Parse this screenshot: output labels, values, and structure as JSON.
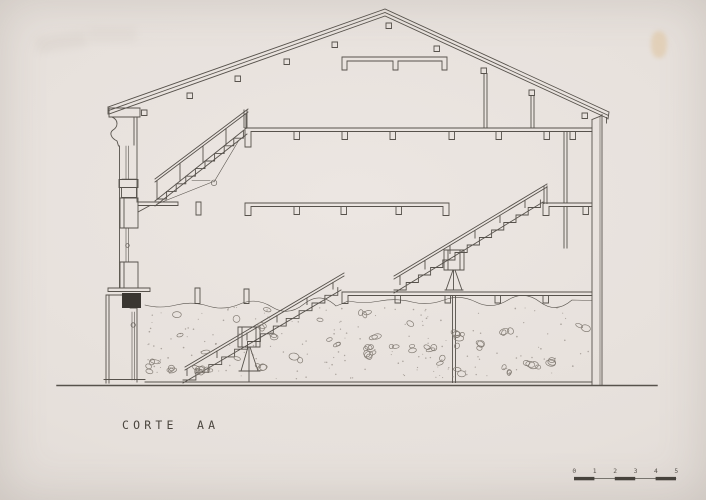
{
  "title": {
    "word1": "CORTE",
    "word2": "AA"
  },
  "scale_bar": {
    "labels": [
      "0",
      "1",
      "2",
      "3",
      "4",
      "5"
    ]
  },
  "colors": {
    "paper": "#e7e1dc",
    "ink": "#57524c",
    "ink_light": "#837c74",
    "cut_fill": "#3a3631",
    "scale_fill": "#46423c",
    "tape_stain": "#dfc49e"
  }
}
